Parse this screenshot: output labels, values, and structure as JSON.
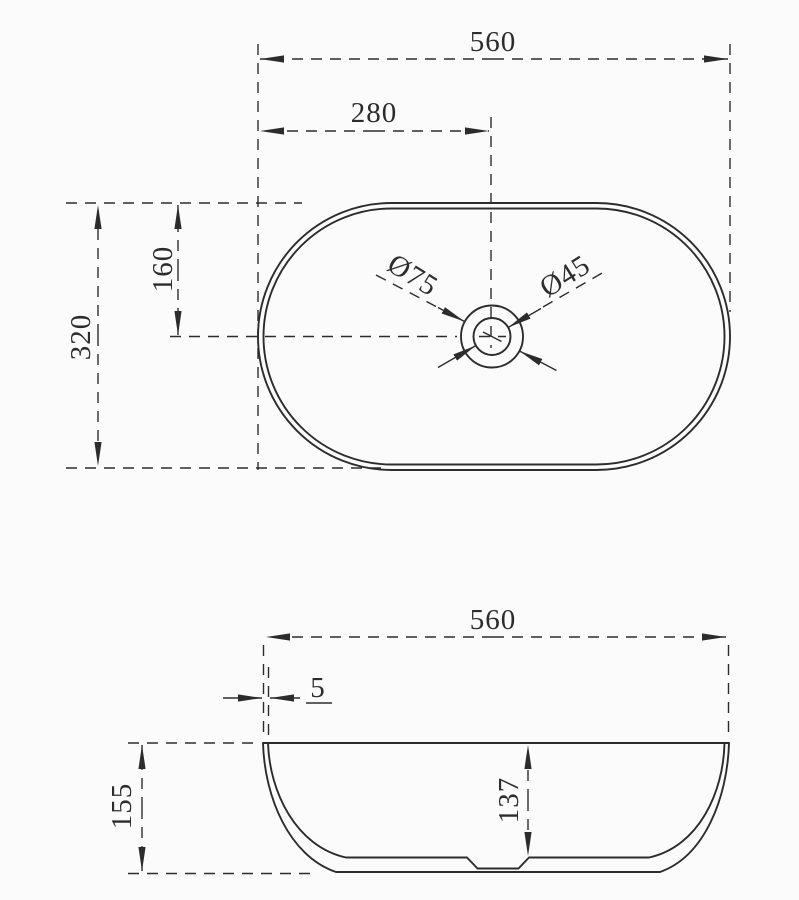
{
  "drawing": {
    "type": "technical-drawing",
    "subject": "oval countertop wash basin, top view and side section with dimensions",
    "units": "mm",
    "views": {
      "top": {
        "overall_width": "560",
        "center_offset_x": "280",
        "overall_depth": "320",
        "center_offset_y": "160",
        "drain_outer_diameter": "Ø75",
        "drain_inner_diameter": "Ø45"
      },
      "side": {
        "overall_width": "560",
        "rim_thickness": "5",
        "overall_height": "155",
        "inner_depth": "137"
      }
    },
    "colors": {
      "line": "#2c2c2c",
      "background": "#fbfbfb"
    }
  }
}
